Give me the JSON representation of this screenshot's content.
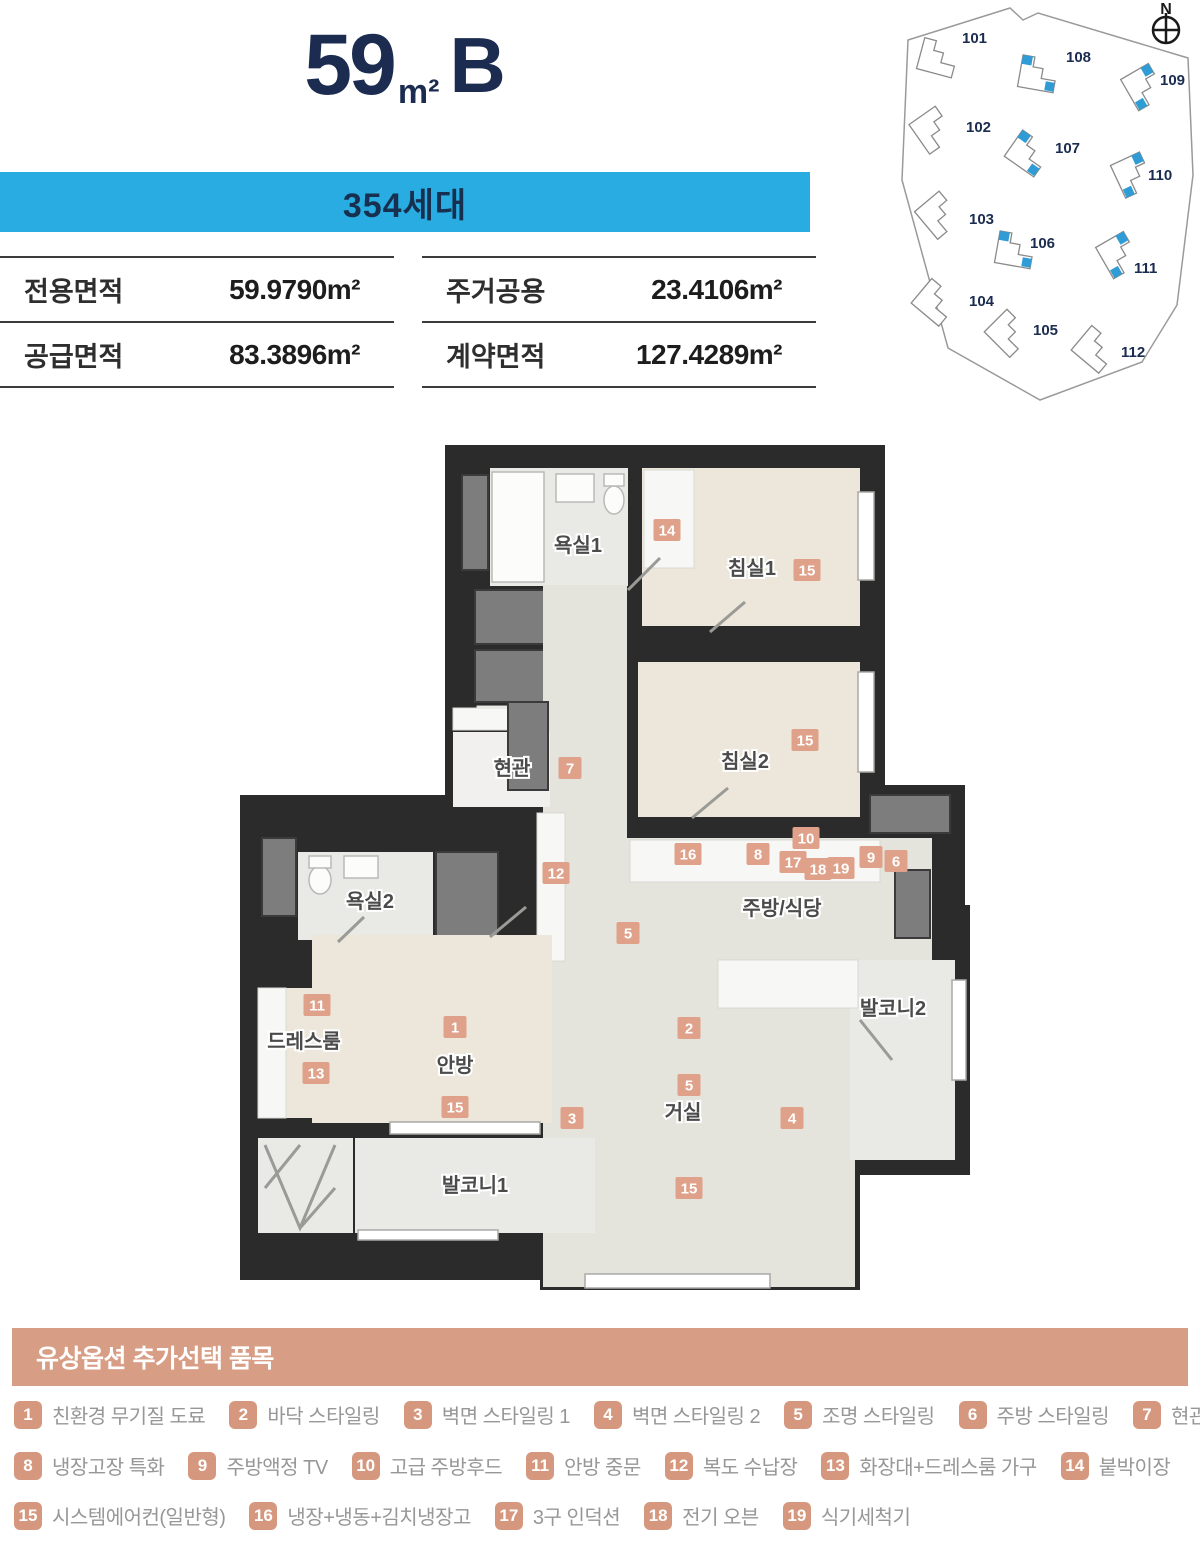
{
  "colors": {
    "accent_blue": "#29ace2",
    "navy": "#1b2c50",
    "salmon_header": "#d89e85",
    "salmon_badge": "#d5987e"
  },
  "header": {
    "area_number": "59",
    "area_unit": "m²",
    "type_letter": "B",
    "households": "354세대"
  },
  "area_table": {
    "cells": [
      {
        "label": "전용면적",
        "value": "59.9790m²"
      },
      {
        "label": "주거공용",
        "value": "23.4106m²"
      },
      {
        "label": "공급면적",
        "value": "83.3896m²"
      },
      {
        "label": "계약면적",
        "value": "127.4289m²"
      }
    ]
  },
  "site_map": {
    "compass": "N",
    "buildings": [
      {
        "id": "101",
        "highlighted": false,
        "fx": 30,
        "fy": 42,
        "lx": 72,
        "ly": 43,
        "rot": 15
      },
      {
        "id": "108",
        "highlighted": true,
        "fx": 130,
        "fy": 58,
        "lx": 176,
        "ly": 62,
        "rot": 10
      },
      {
        "id": "109",
        "highlighted": true,
        "fx": 235,
        "fy": 72,
        "lx": 270,
        "ly": 85,
        "rot": 60
      },
      {
        "id": "102",
        "highlighted": false,
        "fx": 24,
        "fy": 115,
        "lx": 76,
        "ly": 132,
        "rot": 55
      },
      {
        "id": "107",
        "highlighted": true,
        "fx": 120,
        "fy": 138,
        "lx": 165,
        "ly": 153,
        "rot": 35
      },
      {
        "id": "110",
        "highlighted": true,
        "fx": 224,
        "fy": 160,
        "lx": 258,
        "ly": 180,
        "rot": 65
      },
      {
        "id": "103",
        "highlighted": false,
        "fx": 30,
        "fy": 200,
        "lx": 79,
        "ly": 224,
        "rot": 50
      },
      {
        "id": "106",
        "highlighted": true,
        "fx": 107,
        "fy": 234,
        "lx": 140,
        "ly": 248,
        "rot": 10
      },
      {
        "id": "111",
        "highlighted": true,
        "fx": 210,
        "fy": 240,
        "lx": 244,
        "ly": 273,
        "rot": 60
      },
      {
        "id": "104",
        "highlighted": false,
        "fx": 27,
        "fy": 287,
        "lx": 79,
        "ly": 306,
        "rot": 40
      },
      {
        "id": "105",
        "highlighted": false,
        "fx": 100,
        "fy": 318,
        "lx": 143,
        "ly": 335,
        "rot": 45
      },
      {
        "id": "112",
        "highlighted": false,
        "fx": 187,
        "fy": 334,
        "lx": 231,
        "ly": 357,
        "rot": 40
      }
    ]
  },
  "floor_plan": {
    "rooms": [
      {
        "name": "욕실1",
        "x": 338,
        "y": 112
      },
      {
        "name": "침실1",
        "x": 512,
        "y": 135
      },
      {
        "name": "침실2",
        "x": 505,
        "y": 328
      },
      {
        "name": "현관",
        "x": 272,
        "y": 335
      },
      {
        "name": "욕실2",
        "x": 130,
        "y": 468
      },
      {
        "name": "주방/식당",
        "x": 542,
        "y": 475
      },
      {
        "name": "드레스룸",
        "x": 64,
        "y": 608
      },
      {
        "name": "안방",
        "x": 215,
        "y": 632
      },
      {
        "name": "발코니1",
        "x": 235,
        "y": 752
      },
      {
        "name": "거실",
        "x": 443,
        "y": 679
      },
      {
        "name": "발코니2",
        "x": 653,
        "y": 575
      }
    ],
    "markers": [
      {
        "n": "14",
        "x": 427,
        "y": 90
      },
      {
        "n": "15",
        "x": 567,
        "y": 130
      },
      {
        "n": "15",
        "x": 565,
        "y": 300
      },
      {
        "n": "7",
        "x": 330,
        "y": 328
      },
      {
        "n": "12",
        "x": 316,
        "y": 433
      },
      {
        "n": "16",
        "x": 448,
        "y": 414
      },
      {
        "n": "8",
        "x": 518,
        "y": 414
      },
      {
        "n": "10",
        "x": 566,
        "y": 398
      },
      {
        "n": "17",
        "x": 553,
        "y": 422
      },
      {
        "n": "18",
        "x": 578,
        "y": 429
      },
      {
        "n": "19",
        "x": 601,
        "y": 428
      },
      {
        "n": "9",
        "x": 631,
        "y": 417
      },
      {
        "n": "6",
        "x": 656,
        "y": 421
      },
      {
        "n": "5",
        "x": 388,
        "y": 493
      },
      {
        "n": "11",
        "x": 77,
        "y": 565
      },
      {
        "n": "13",
        "x": 76,
        "y": 633
      },
      {
        "n": "1",
        "x": 215,
        "y": 587
      },
      {
        "n": "15",
        "x": 215,
        "y": 667
      },
      {
        "n": "3",
        "x": 332,
        "y": 678
      },
      {
        "n": "2",
        "x": 449,
        "y": 588
      },
      {
        "n": "5",
        "x": 449,
        "y": 645
      },
      {
        "n": "4",
        "x": 552,
        "y": 678
      },
      {
        "n": "15",
        "x": 449,
        "y": 748
      }
    ]
  },
  "options": {
    "title": "유상옵션 추가선택 품목",
    "rows": [
      [
        {
          "num": "1",
          "label": "친환경 무기질 도료"
        },
        {
          "num": "2",
          "label": "바닥 스타일링"
        },
        {
          "num": "3",
          "label": "벽면 스타일링 1"
        },
        {
          "num": "4",
          "label": "벽면 스타일링 2"
        },
        {
          "num": "5",
          "label": "조명 스타일링"
        },
        {
          "num": "6",
          "label": "주방 스타일링"
        },
        {
          "num": "7",
          "label": "현관중문"
        }
      ],
      [
        {
          "num": "8",
          "label": "냉장고장 특화"
        },
        {
          "num": "9",
          "label": "주방액정 TV"
        },
        {
          "num": "10",
          "label": "고급 주방후드"
        },
        {
          "num": "11",
          "label": "안방 중문"
        },
        {
          "num": "12",
          "label": "복도 수납장"
        },
        {
          "num": "13",
          "label": "화장대+드레스룸 가구"
        },
        {
          "num": "14",
          "label": "붙박이장"
        }
      ],
      [
        {
          "num": "15",
          "label": "시스템에어컨(일반형)"
        },
        {
          "num": "16",
          "label": "냉장+냉동+김치냉장고"
        },
        {
          "num": "17",
          "label": "3구 인덕션"
        },
        {
          "num": "18",
          "label": "전기 오븐"
        },
        {
          "num": "19",
          "label": "식기세척기"
        }
      ]
    ]
  }
}
